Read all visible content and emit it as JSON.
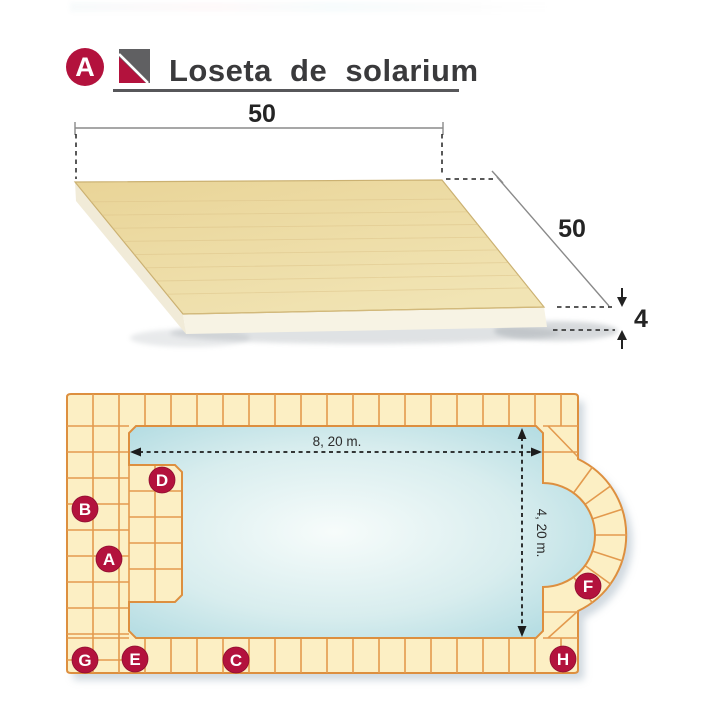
{
  "header": {
    "badge_letter": "A",
    "title": "Loseta de solarium"
  },
  "tile_figure": {
    "width_label": "50",
    "depth_label": "50",
    "thickness_label": "4",
    "tile_color": "#ecd9a0"
  },
  "pool_plan": {
    "length_label": "8, 20 m.",
    "width_label": "4, 20 m.",
    "markers": [
      {
        "letter": "A"
      },
      {
        "letter": "B"
      },
      {
        "letter": "C"
      },
      {
        "letter": "D"
      },
      {
        "letter": "E"
      },
      {
        "letter": "F"
      },
      {
        "letter": "G"
      },
      {
        "letter": "H"
      }
    ],
    "colors": {
      "deck": "#fcefc4",
      "grout": "#e39a4e",
      "border": "#dd8f3f",
      "water_edge": "#a0d3dc",
      "badge_red": "#b3123d",
      "dimension_black": "#1c1c1c"
    }
  }
}
